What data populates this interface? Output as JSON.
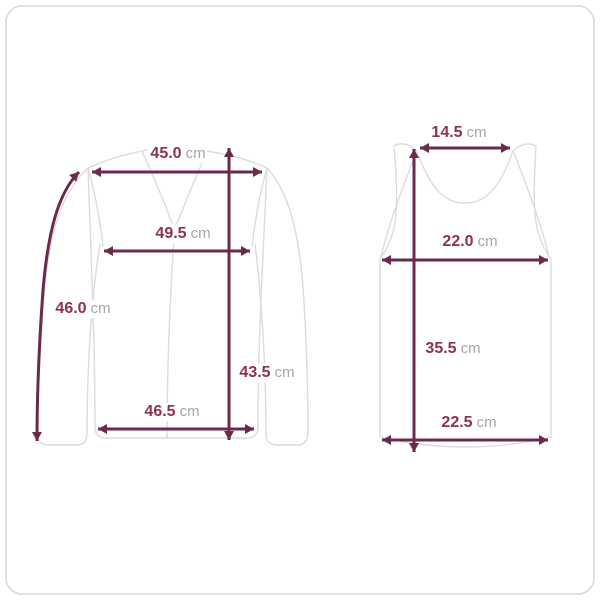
{
  "page": {
    "type": "size-chart-diagram",
    "unit": "cm",
    "colors": {
      "arrow": "#6b2a4c",
      "value_text": "#8d3056",
      "unit_text": "#a6a6a6",
      "garment_outline": "#dcdcdc",
      "card_border": "#d8d8d8",
      "background": "#ffffff"
    }
  },
  "diagram": {
    "garments": [
      {
        "name": "long-sleeve-top",
        "measurements": [
          {
            "label": "shoulder-width",
            "value": "45.0",
            "unit": "cm"
          },
          {
            "label": "chest-width",
            "value": "49.5",
            "unit": "cm"
          },
          {
            "label": "sleeve-length",
            "value": "46.0",
            "unit": "cm"
          },
          {
            "label": "total-length",
            "value": "43.5",
            "unit": "cm"
          },
          {
            "label": "hem-width",
            "value": "46.5",
            "unit": "cm"
          }
        ]
      },
      {
        "name": "sleeveless-top",
        "measurements": [
          {
            "label": "neck-width",
            "value": "14.5",
            "unit": "cm"
          },
          {
            "label": "chest-width",
            "value": "22.0",
            "unit": "cm"
          },
          {
            "label": "total-length",
            "value": "35.5",
            "unit": "cm"
          },
          {
            "label": "hem-width",
            "value": "22.5",
            "unit": "cm"
          }
        ]
      }
    ]
  }
}
